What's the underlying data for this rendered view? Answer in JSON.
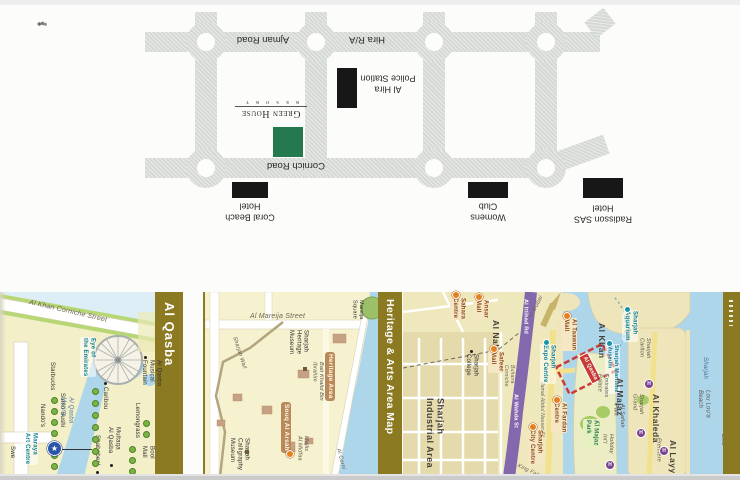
{
  "top_map": {
    "road_labels": [
      {
        "name": "ajman-road-label",
        "text": "Ajman Road",
        "x": 218,
        "y": 33,
        "w": 90
      },
      {
        "name": "hira-ra-label",
        "text": "Hira R/A",
        "x": 338,
        "y": 33,
        "w": 58
      },
      {
        "name": "cornich-road-label",
        "text": "Cornich Road",
        "x": 246,
        "y": 159,
        "w": 100
      }
    ],
    "logo": {
      "title": "Green House",
      "subtitle": "R E S O R T"
    },
    "sites": [
      {
        "name": "al-hira-police-station-label",
        "text": "Al Hira\nPolice Station",
        "x": 356,
        "y": 72,
        "w": 64
      },
      {
        "name": "coral-beach-hotel-label",
        "text": "Coral Beach\nHotel",
        "x": 214,
        "y": 200,
        "w": 72
      },
      {
        "name": "womens-club-label",
        "text": "Womens\nClub",
        "x": 455,
        "y": 200,
        "w": 66
      },
      {
        "name": "radisson-sas-hotel-label",
        "text": "Radisson SAS\nHotel",
        "x": 564,
        "y": 202,
        "w": 78
      }
    ]
  },
  "bottom": {
    "bars": [
      {
        "name": "bar-al-qasba",
        "text": "Al Qasba"
      },
      {
        "name": "bar-heritage",
        "text": "Heritage & Arts Area Map"
      },
      {
        "name": "bar-right",
        "text": ""
      }
    ],
    "labels": [
      {
        "name": "al-khan-corniche-street",
        "text": "Al Khan Corniche Street",
        "cls": "road hz",
        "x": 30,
        "y": 299,
        "rot": 13,
        "fs": 7
      },
      {
        "name": "eye-of-the-emirates",
        "text": "Eye of\nthe Emirates",
        "cls": "teal",
        "x": 80,
        "y": 337
      },
      {
        "name": "al-qasba-musical-fountain",
        "text": "Al Qasba\nMusical\nFountain",
        "cls": "black",
        "x": 140,
        "y": 360
      },
      {
        "name": "starbucks",
        "text": "Starbucks",
        "cls": "black",
        "x": 48,
        "y": 362
      },
      {
        "name": "sumo-sushi",
        "text": "Sumo Sushi",
        "cls": "black",
        "x": 58,
        "y": 393
      },
      {
        "name": "nandos",
        "text": "Nando's",
        "cls": "black",
        "x": 38,
        "y": 404
      },
      {
        "name": "caribou",
        "text": "Caribou",
        "cls": "black",
        "x": 101,
        "y": 387
      },
      {
        "name": "lemongrass",
        "text": "Lemongrass",
        "cls": "black",
        "x": 133,
        "y": 403
      },
      {
        "name": "multaqa-al-qasba",
        "text": "Multaqa\nAl Qasba",
        "cls": "black",
        "x": 106,
        "y": 427
      },
      {
        "name": "shababeel",
        "text": "Shababeel",
        "cls": "black",
        "x": 93,
        "y": 435
      },
      {
        "name": "bool-mall",
        "text": "Bool\nMall",
        "cls": "black",
        "x": 140,
        "y": 446
      },
      {
        "name": "al-qasba-marina",
        "text": "Al Qasba\nMarina",
        "cls": "blueit",
        "x": 59,
        "y": 397
      },
      {
        "name": "maraya-art-centre",
        "text": "Maraya\nArt Centre",
        "cls": "teal",
        "x": 22,
        "y": 432
      },
      {
        "name": "swensens-partial",
        "text": "Swe",
        "cls": "black",
        "x": 8,
        "y": 446
      },
      {
        "name": "al-mareija-street",
        "text": "Al Mareija Street",
        "cls": "road hz",
        "x": 250,
        "y": 313,
        "fs": 7
      },
      {
        "name": "mareija-square",
        "text": "Mareija\nSquare",
        "cls": "black",
        "x": 351,
        "y": 300,
        "fs": 5.5
      },
      {
        "name": "sharjah-heritage-museum",
        "text": "Sharjah\nHeritage\nMuseum",
        "cls": "black",
        "x": 287,
        "y": 330
      },
      {
        "name": "heritage-area",
        "text": "Heritage Area",
        "cls": "hl",
        "x": 325,
        "y": 352
      },
      {
        "name": "bait-khalid-bin-ibrahim",
        "text": "Bait Khalid Bin\nIbrahim",
        "cls": "it",
        "x": 311,
        "y": 362
      },
      {
        "name": "souq-al-arsah",
        "text": "Souq Al Arsah",
        "cls": "hl",
        "x": 281,
        "y": 402
      },
      {
        "name": "sharjah-calligraphy-museum",
        "text": "Sharjah\nCalligraphy\nMuseum",
        "cls": "black",
        "x": 228,
        "y": 438
      },
      {
        "name": "majlis-al-midfaa",
        "text": "Majlis\nAl Midfaa",
        "cls": "it",
        "x": 296,
        "y": 436
      },
      {
        "name": "sharjah-wall",
        "text": "Sharjah Wall",
        "cls": "it hz",
        "x": 237,
        "y": 336,
        "rot": 72
      },
      {
        "name": "al-corniche-partial",
        "text": "Al Corni",
        "cls": "it hz",
        "x": 341,
        "y": 448,
        "rot": 75
      },
      {
        "name": "sharjah-industrial-area",
        "text": "Sharjah\nIndustrial Area",
        "cls": "big",
        "x": 424,
        "y": 398,
        "fs": 9
      },
      {
        "name": "sharjah-college",
        "text": "Sharjah\nCollege",
        "cls": "black",
        "x": 464,
        "y": 354
      },
      {
        "name": "al-nahda",
        "text": "Al Nahda",
        "cls": "big",
        "x": 491,
        "y": 320
      },
      {
        "name": "sahara-centre",
        "text": "Sahara\nCentre",
        "cls": "brown",
        "x": 450,
        "y": 297
      },
      {
        "name": "ansar-mall",
        "text": "Ansar\nMall",
        "cls": "brown",
        "x": 473,
        "y": 299
      },
      {
        "name": "safeer-mall",
        "text": "Safeer\nMall",
        "cls": "brown",
        "x": 488,
        "y": 351
      },
      {
        "name": "to-dubai",
        "text": "to Dubai",
        "cls": "road hz",
        "x": 528,
        "y": 316,
        "rot": -62
      },
      {
        "name": "al-ittihad-rd",
        "text": "Al Ittihad Rd",
        "cls": "white",
        "x": 522,
        "y": 299
      },
      {
        "name": "al-wahda-st",
        "text": "Al Wahda St",
        "cls": "white",
        "x": 512,
        "y": 394
      },
      {
        "name": "buhaira-corniche",
        "text": "Buhaira\nCorniche",
        "cls": "road",
        "x": 503,
        "y": 365,
        "fs": 5
      },
      {
        "name": "jamal-abdul-nasser-st",
        "text": "Jamal Abdul Nasser St",
        "cls": "road",
        "x": 539,
        "y": 382,
        "fs": 5
      },
      {
        "name": "king-faisal-st",
        "text": "King Faisal St",
        "cls": "road hz",
        "x": 519,
        "y": 463,
        "rot": 25,
        "fs": 5.5
      },
      {
        "name": "sharjah-expo-centre",
        "text": "Sharjah\nExpo Centre",
        "cls": "teal",
        "x": 540,
        "y": 344
      },
      {
        "name": "al-taawun-mall",
        "text": "Al Taawun\nMall",
        "cls": "brown",
        "x": 561,
        "y": 318
      },
      {
        "name": "al-khan",
        "text": "Al Khan",
        "cls": "big",
        "x": 597,
        "y": 323
      },
      {
        "name": "sharjah-aquarium",
        "text": "Sharjah\nAquarium",
        "cls": "teal",
        "x": 622,
        "y": 310
      },
      {
        "name": "sharjah-maritime-museum",
        "text": "Sharjah Maritime\nMuseum",
        "cls": "teal",
        "x": 605,
        "y": 344,
        "fs": 5.5
      },
      {
        "name": "al-qasba-zone",
        "text": "Al Qasba",
        "cls": "red",
        "x": 578,
        "y": 357,
        "rot": -27
      },
      {
        "name": "al-fardan-centre",
        "text": "Al Fardan\nCentre",
        "cls": "brown",
        "x": 551,
        "y": 402
      },
      {
        "name": "sharjah-city-centre",
        "text": "Sharjah\nCity Centre",
        "cls": "brown",
        "x": 527,
        "y": 429
      },
      {
        "name": "al-majaz",
        "text": "Al Majaz",
        "cls": "big",
        "x": 615,
        "y": 378
      },
      {
        "name": "emirates-palace",
        "text": "Emirates\nPalace",
        "cls": "it",
        "x": 596,
        "y": 374
      },
      {
        "name": "al-safiah-park",
        "text": "Al Safiah\nPark",
        "cls": "it",
        "x": 612,
        "y": 404
      },
      {
        "name": "al-majaz-park",
        "text": "Al Majaz\nPark",
        "cls": "green",
        "x": 583,
        "y": 419
      },
      {
        "name": "al-khaleda",
        "text": "Al Khaleda",
        "cls": "big",
        "x": 651,
        "y": 394
      },
      {
        "name": "sharjah-carlton",
        "text": "Sharjah\nCarlton",
        "cls": "it",
        "x": 638,
        "y": 338
      },
      {
        "name": "sharjah-grand",
        "text": "Sharjah\nGrand",
        "cls": "it",
        "x": 631,
        "y": 394
      },
      {
        "name": "premiere",
        "text": "Premiere",
        "cls": "it",
        "x": 655,
        "y": 438
      },
      {
        "name": "holiday-intl",
        "text": "Holiday\nInt'l",
        "cls": "it",
        "x": 601,
        "y": 434
      },
      {
        "name": "lou-loua-beach",
        "text": "Lou Lou'a\nBeach",
        "cls": "it",
        "x": 696,
        "y": 390,
        "fs": 6
      },
      {
        "name": "gold-beach-partial",
        "text": "Gold\nBea",
        "cls": "it",
        "x": 719,
        "y": 434,
        "fs": 6
      },
      {
        "name": "sharjah-sea-label",
        "text": "Sharjah",
        "cls": "blueit",
        "x": 701,
        "y": 357
      },
      {
        "name": "al-layy-partial",
        "text": "Al Layy",
        "cls": "big",
        "x": 668,
        "y": 440
      }
    ],
    "markers": [
      {
        "type": "pin-orange",
        "x": 452,
        "y": 291
      },
      {
        "type": "pin-orange",
        "x": 475,
        "y": 293
      },
      {
        "type": "pin-orange",
        "x": 490,
        "y": 345
      },
      {
        "type": "pin-orange",
        "x": 563,
        "y": 312
      },
      {
        "type": "pin-orange",
        "x": 553,
        "y": 396
      },
      {
        "type": "pin-orange",
        "x": 529,
        "y": 423
      },
      {
        "type": "pin-orange",
        "x": 286,
        "y": 450
      },
      {
        "type": "pin-hotel",
        "x": 644,
        "y": 379
      },
      {
        "type": "pin-hotel",
        "x": 636,
        "y": 428
      },
      {
        "type": "pin-hotel",
        "x": 659,
        "y": 446
      },
      {
        "type": "pin-hotel",
        "x": 605,
        "y": 460
      },
      {
        "type": "dot",
        "x": 104,
        "y": 382
      },
      {
        "type": "dot",
        "x": 110,
        "y": 464
      },
      {
        "type": "dot",
        "x": 96,
        "y": 471
      },
      {
        "type": "dot",
        "x": 144,
        "y": 356
      },
      {
        "type": "dot",
        "x": 470,
        "y": 350
      },
      {
        "type": "sq",
        "x": 303,
        "y": 367
      },
      {
        "type": "sq",
        "x": 245,
        "y": 450
      },
      {
        "type": "dot-teal",
        "x": 543,
        "y": 339
      },
      {
        "type": "dot-teal",
        "x": 624,
        "y": 306
      },
      {
        "type": "dot-teal",
        "x": 606,
        "y": 340
      },
      {
        "type": "pin-star",
        "x": 47,
        "y": 441
      }
    ],
    "tree_columns": [
      {
        "x": 51,
        "y": 397,
        "n": 7,
        "dy": 11
      },
      {
        "x": 92,
        "y": 388,
        "n": 7,
        "dy": 12
      },
      {
        "x": 129,
        "y": 446,
        "n": 3,
        "dy": 11
      },
      {
        "x": 143,
        "y": 420,
        "n": 2,
        "dy": 11
      }
    ]
  }
}
